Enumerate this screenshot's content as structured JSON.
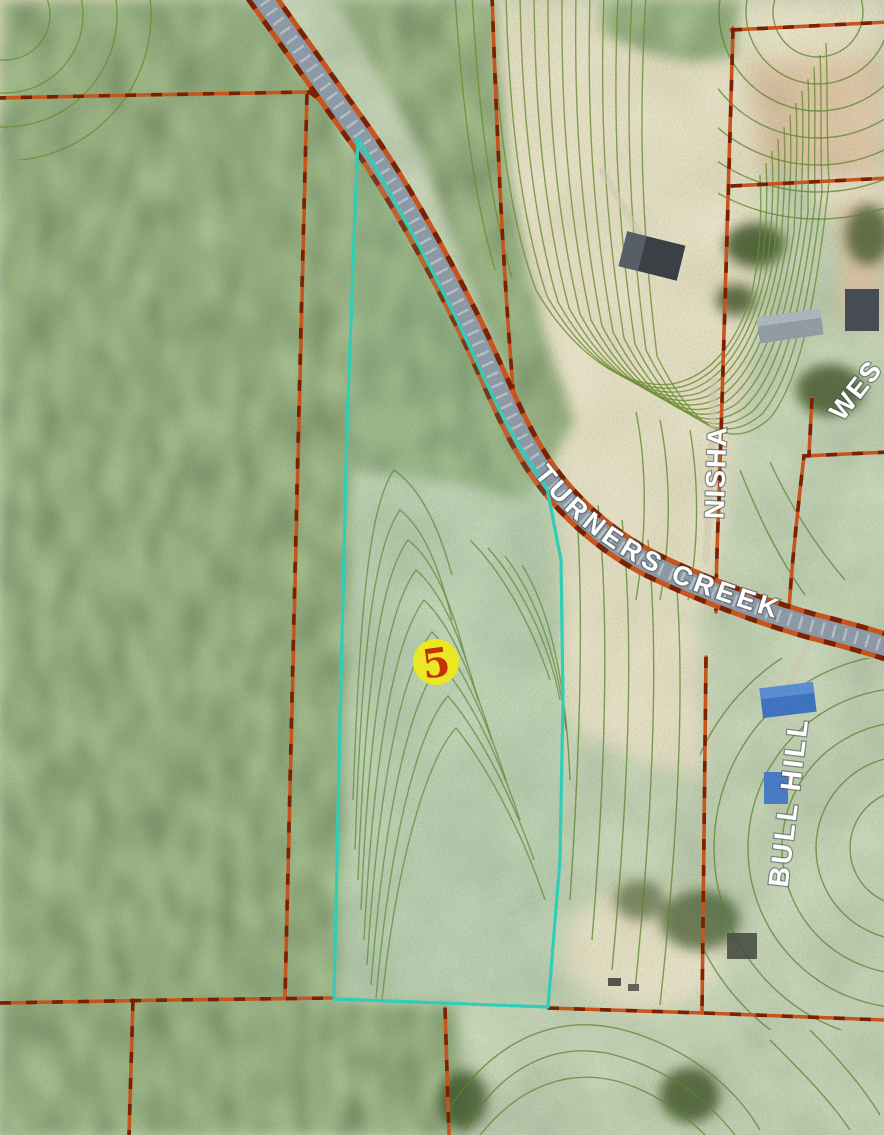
{
  "map": {
    "labels": {
      "turners_creek": "TURNERS CREEK",
      "nisha": "NISHA",
      "wes_partial": "WES",
      "bull_hill": "BULL HILL"
    },
    "marker": {
      "value": "5",
      "circle_color": "#ece724",
      "text_color": "#c43104"
    },
    "colors": {
      "highlight_parcel": "#2fd9c0",
      "parcel_boundary": "#d3561b",
      "parcel_boundary_dash": "#7d1f00",
      "contour_line": "#5d8a2d",
      "road_surface": "#93a0ae",
      "label_text": "#ffffff"
    }
  }
}
